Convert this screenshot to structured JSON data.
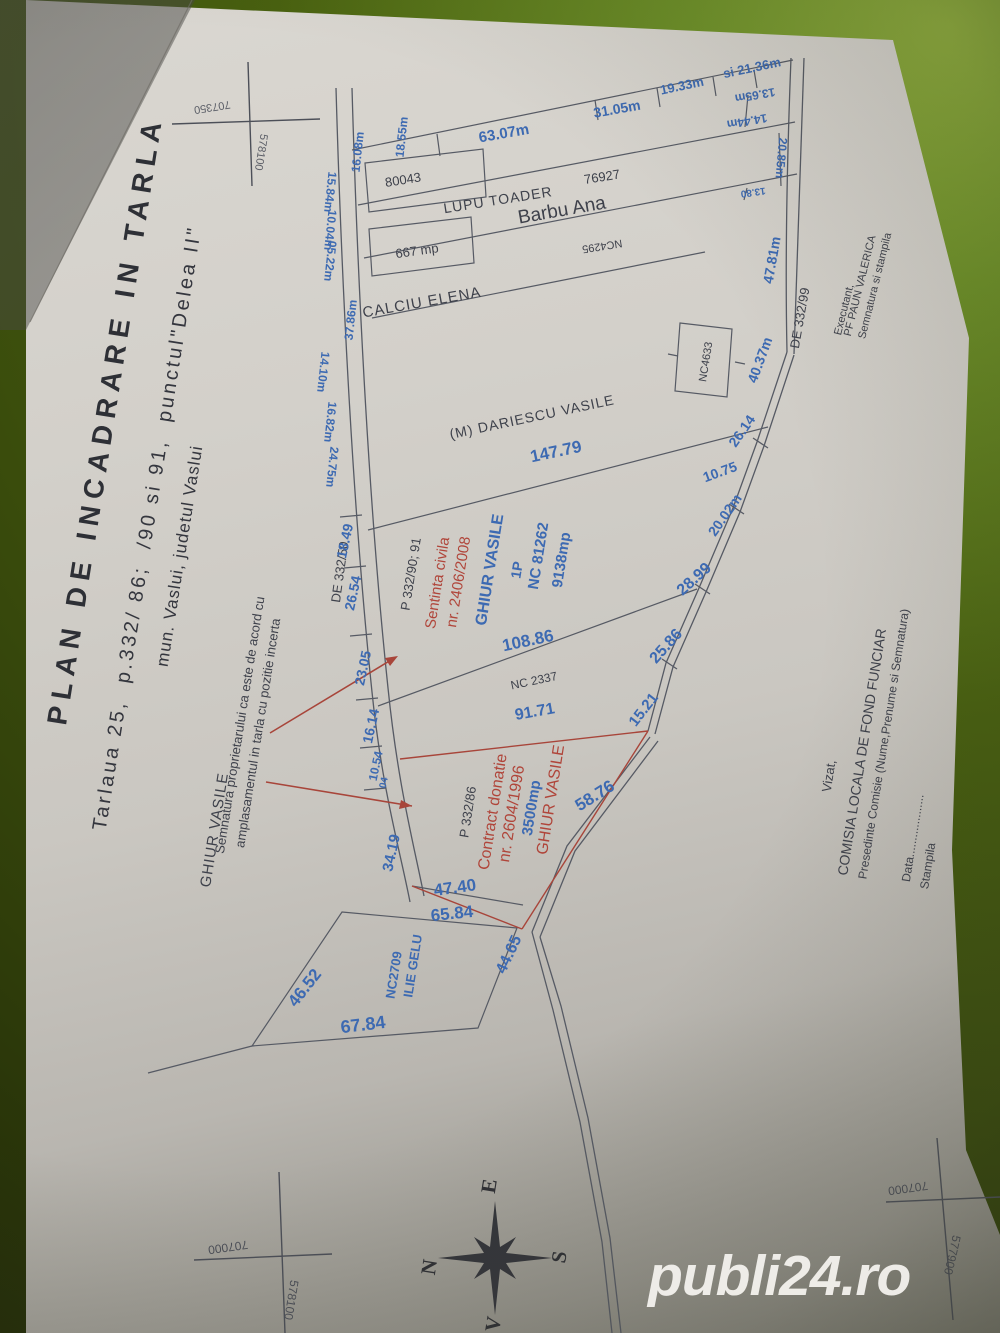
{
  "watermark": "publi24.ro",
  "title_block": {
    "line1": "PLAN DE INCADRARE IN TARLA",
    "line2": "Tarlaua 25,  p.332/ 86;  /90 si 91,  punctul\"Delea II\"",
    "line3": "mun. Vaslui, judetul Vaslui"
  },
  "consent_note": {
    "owner": "GHIUR VASILE",
    "line1": "Semnatura proprietarului ca este de acord cu",
    "line2": "amplasamentul in tarla cu pozitie incerta"
  },
  "roads": {
    "left": "DE 332/50",
    "right": "DE 332/99"
  },
  "neighbors": {
    "dariescu": "(M) DARIESCU VASILE",
    "calciu": "CALCIU ELENA",
    "lupu": "LUPU TOADER",
    "barbu": "Barbu Ana",
    "ilie_nc": "NC2709",
    "ilie_name": "ILIE GELU"
  },
  "top_parcels": {
    "nc_80043": "80043",
    "nc_76927": "76927",
    "area_667": "667 mp",
    "nc_4295": "NC4295",
    "nc_4633": "NC4633"
  },
  "parcel_sentinta": {
    "p": "P 332/90; 91",
    "doc1": "Sentinta civila",
    "doc2": "nr. 2406/2008",
    "owner": "GHIUR VASILE",
    "floor": "1P",
    "nc": "NC 81262",
    "area": "9138mp",
    "nc2337": "NC 2337"
  },
  "parcel_contract": {
    "p": "P 332/86",
    "doc1": "Contract donatie",
    "doc2": "nr. 2604/1996",
    "area": "3500mp",
    "owner": "GHIUR VASILE"
  },
  "dims": {
    "d63_07": "63.07m",
    "d31_05": "31.05m",
    "d19_33": "19.33m",
    "d21_36": "si 21.36m",
    "d13_65": "13.65m",
    "d14_44": "14.44m",
    "d20_85": "20.85m",
    "d13_80": "13.80",
    "d47_81": "47.81m",
    "d16_08": "16.08m",
    "d18_55": "18.55m",
    "d15_84": "15.84m",
    "d10_04": "10.04m",
    "d05_22": "05.22m",
    "d37_86": "37.86m",
    "d14_10": "14.10m",
    "d16_82": "16.82m",
    "d24_75": "24.75m",
    "d18_49": "18.49",
    "d26_54": "26.54",
    "d23_05": "23.05",
    "d16_14": "16.14",
    "d10_54": "10.54",
    "d04": "04",
    "d34_19": "34.19",
    "d147_79": "147.79",
    "d108_86": "108.86",
    "d91_71": "91.71",
    "d40_37": "40.37m",
    "d26_14": "26.14",
    "d10_75": "10.75",
    "d20_02": "20.02m",
    "d28_99": "28.99",
    "d25_86": "25.86",
    "d15_21": "15.21",
    "d58_76": "58.76",
    "d47_40": "47.40",
    "d65_84": "65.84",
    "d46_52": "46.52",
    "d67_84": "67.84",
    "d44_65": "44.65"
  },
  "compass": {
    "e": "E",
    "n": "N",
    "s": "S",
    "v": "V"
  },
  "grid": {
    "tl_top": "707350",
    "tl_side": "578100",
    "bl_top": "707000",
    "bl_side": "578100",
    "br_top": "707000",
    "br_side": "577900"
  },
  "approval": {
    "l1": "Vizat,",
    "l2": "COMISIA LOCALA DE FOND FUNCIAR",
    "l3": "Presedinte Comisie (Nume,Prenume si Semnatura)",
    "l4": "Data...................",
    "l5": "Stampila"
  },
  "executant": {
    "l1": "Executant,",
    "l2": "PF PAUN VALERICA",
    "l3": "Semnatura si stampila"
  },
  "colors": {
    "dim_blue": "#3d6ab2",
    "red": "#b0453a",
    "ink": "#3e414b",
    "line": "#565a64"
  }
}
